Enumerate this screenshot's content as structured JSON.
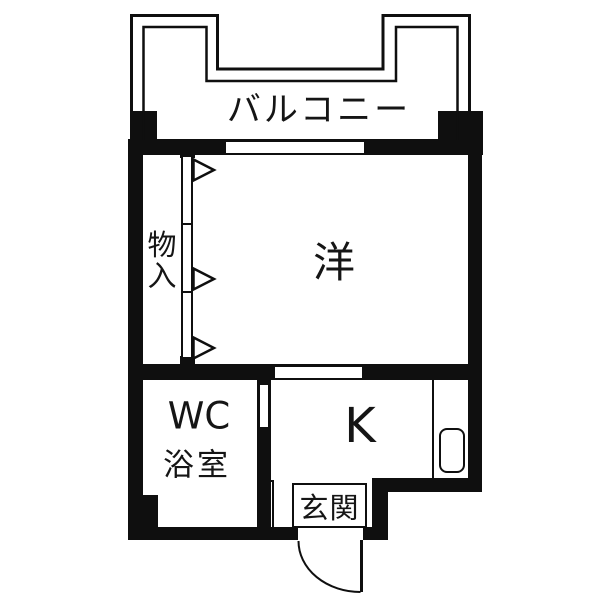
{
  "colors": {
    "wall": "#0f0f0f",
    "background": "#ffffff"
  },
  "rooms": {
    "balcony": "バルコニー",
    "western_room": "洋",
    "storage_char_top": "物",
    "storage_char_bottom": "入",
    "wc": "WC",
    "bath": "浴室",
    "kitchen": "K",
    "entrance": "玄関"
  }
}
